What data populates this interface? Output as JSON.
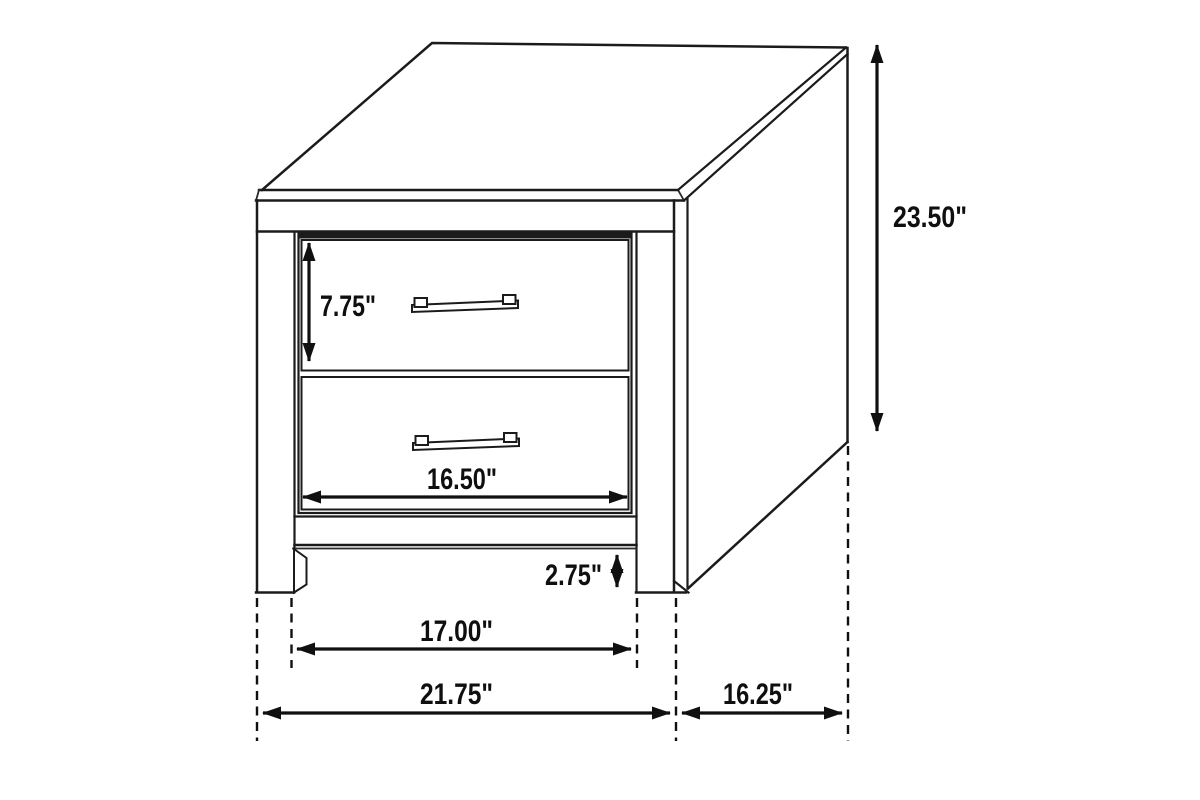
{
  "diagram": {
    "background": "#ffffff",
    "line_color": "#1b1b1b",
    "text_color": "#0f0f0f",
    "dimensions": {
      "overall_height": "23.50\"",
      "drawer_height": "7.75\"",
      "drawer_width": "16.50\"",
      "base_clearance": "2.75\"",
      "base_width": "17.00\"",
      "overall_width": "21.75\"",
      "overall_depth": "16.25\""
    }
  }
}
